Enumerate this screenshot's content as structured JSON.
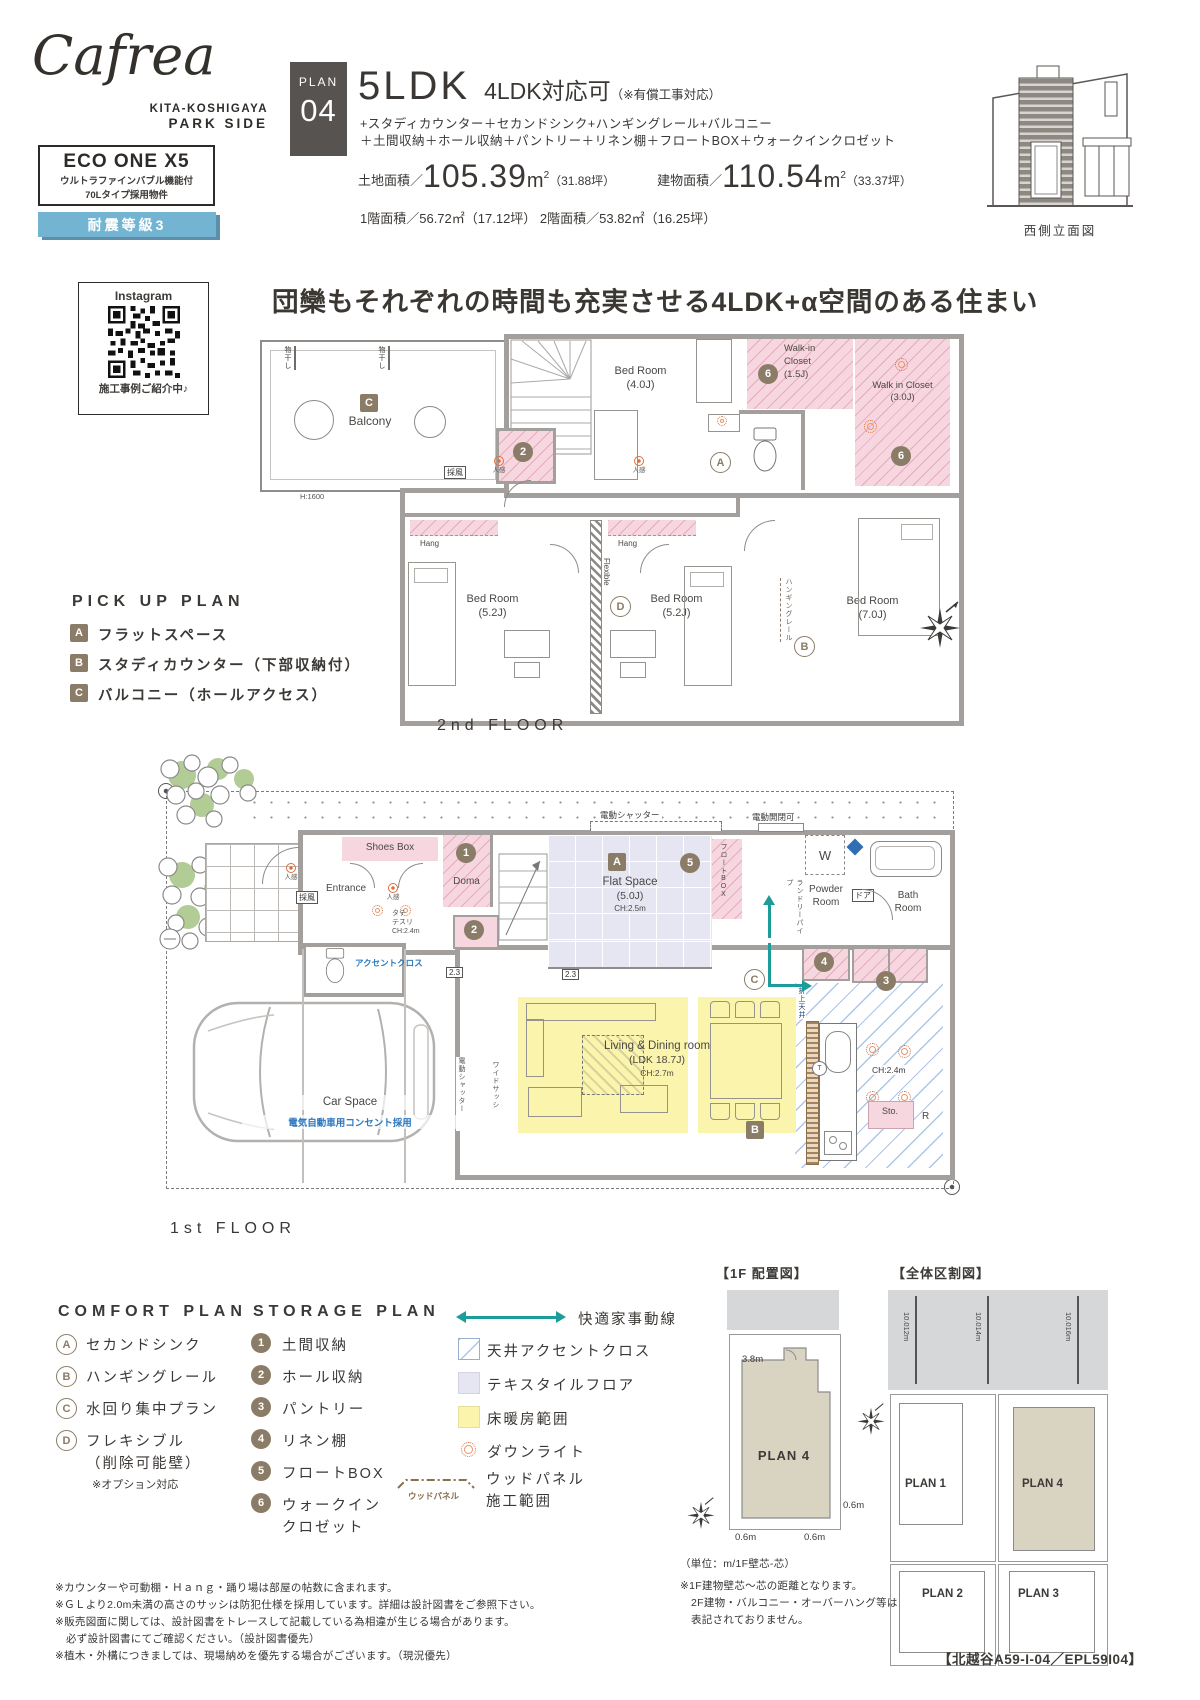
{
  "brand": {
    "logo": "Cafrea",
    "sub1": "KITA-KOSHIGAYA",
    "sub2": "PARK SIDE",
    "eco_title": "ECO ONE X5",
    "eco_line1": "ウルトラファインバブル機能付",
    "eco_line2": "70Lタイプ採用物件",
    "seismic": "耐震等級3"
  },
  "plan_header": {
    "plan_label": "PLAN",
    "plan_no": "04",
    "ldk": "5LDK",
    "convert": "4LDK対応可",
    "convert_note": "（※有償工事対応）",
    "feat1": "+スタディカウンター＋セカンドシンク+ハンギングレール+バルコニー",
    "feat2": "＋土間収納＋ホール収納＋パントリー＋リネン棚＋フロートBOX＋ウォークインクロゼット",
    "land_label": "土地面積／",
    "land_value": "105.39",
    "unit": "m",
    "sup": "2",
    "land_tsubo": "（31.88坪）",
    "bldg_label": "建物面積／",
    "bldg_value": "110.54",
    "bldg_tsubo": "（33.37坪）",
    "floor_line": "1階面積／56.72㎡（17.12坪） 2階面積／53.82㎡（16.25坪）",
    "elevation_caption": "西側立面図"
  },
  "instagram": {
    "title": "Instagram",
    "caption": "施工事例ご紹介中♪"
  },
  "headline": "団欒もそれぞれの時間も充実させる4LDK+α空間のある住まい",
  "pickup_plan": {
    "title": "PICK UP PLAN",
    "items": [
      {
        "b": "A",
        "t": "フラットスペース"
      },
      {
        "b": "B",
        "t": "スタディカウンター（下部収納付）"
      },
      {
        "b": "C",
        "t": "バルコニー（ホールアクセス）"
      }
    ]
  },
  "floor2": {
    "label": "2nd FLOOR",
    "balcony": "Balcony",
    "monohoshi": "物干し",
    "saifu": "採風",
    "h1600": "H:1600",
    "bed4": "Bed Room",
    "bed4_size": "(4.0J)",
    "ninkan": "人感",
    "wic15_l1": "Walk-in",
    "wic15_l2": "Closet",
    "wic15_size": "(1.5J)",
    "wic30": "Walk in Closet",
    "wic30_size": "(3.0J)",
    "hang": "Hang",
    "bed52": "Bed Room",
    "bed52_size": "(5.2J)",
    "flexible": "Flexible",
    "bed7": "Bed Room",
    "bed7_size": "(7.0J)",
    "hanging_rail": "ハンギングレール"
  },
  "floor1": {
    "label": "1st FLOOR",
    "shutter_top": "電動シャッター",
    "auto_open": "電動開閉可",
    "shoes": "Shoes Box",
    "doma": "Doma",
    "entrance": "Entrance",
    "saifu": "採風",
    "ninkan": "人感",
    "tate1": "タテ",
    "tate2": "テスリ",
    "tate3": "CH:2.4m",
    "flat": "Flat Space",
    "flat_size": "(5.0J)",
    "flat_ch": "CH:2.5m",
    "floatbox": "フロートBOX",
    "w": "W",
    "laundry": "ランドリーパイプ",
    "powder1": "Powder",
    "powder2": "Room",
    "door_label": "ドア",
    "bath1": "Bath",
    "bath2": "Room",
    "oriage": "折上天井",
    "ch24": "CH:2.4m",
    "sto": "Sto.",
    "r": "R",
    "ldk1": "Living & Dining room",
    "ldk2": "(LDK 18.7J)",
    "ldk3": "CH:2.7m",
    "marker23": "2.3",
    "accent_cross": "アクセントクロス",
    "car": "Car Space",
    "car_note": "電気自動車用コンセント採用",
    "shutter_side": "電動シャッター",
    "wide_sash": "ワイドサッシ",
    "t": "T"
  },
  "comfort_plan": {
    "title": "COMFORT PLAN",
    "items": [
      {
        "b": "A",
        "t": "セカンドシンク"
      },
      {
        "b": "B",
        "t": "ハンギングレール"
      },
      {
        "b": "C",
        "t": "水回り集中プラン"
      },
      {
        "b": "D",
        "t": "フレキシブル",
        "t2": "（削除可能壁）",
        "note": "※オプション対応"
      }
    ]
  },
  "storage_plan": {
    "title": "STORAGE PLAN",
    "items": [
      {
        "b": "1",
        "t": "土間収納"
      },
      {
        "b": "2",
        "t": "ホール収納"
      },
      {
        "b": "3",
        "t": "パントリー"
      },
      {
        "b": "4",
        "t": "リネン棚"
      },
      {
        "b": "5",
        "t": "フロートBOX"
      },
      {
        "b": "6",
        "t": "ウォークイン",
        "t2": "クロゼット"
      }
    ]
  },
  "legend": {
    "flow": "快適家事動線",
    "ceiling": "天井アクセントクロス",
    "textile": "テキスタイルフロア",
    "heating": "床暖房範囲",
    "downlight": "ダウンライト",
    "wood1": "ウッドパネル",
    "wood2": "施工範囲",
    "wood_tag": "ウッドパネル"
  },
  "site_1f": {
    "title": "【1F 配置図】",
    "plan": "PLAN 4",
    "dim_top": "3.8m",
    "dim_r": "0.6m",
    "dim_bl": "0.6m",
    "dim_br": "0.6m"
  },
  "site_overall": {
    "title": "【全体区割図】",
    "d1": "10.012m",
    "d2": "10.014m",
    "d3": "10.016m",
    "p1": "PLAN 1",
    "p2": "PLAN 2",
    "p3": "PLAN 3",
    "p4": "PLAN 4"
  },
  "site_notes": [
    "（単位：m/1F壁芯-芯）",
    "※1F建物壁芯～芯の距離となります。",
    "2F建物・バルコニー・オーバーハング等は",
    "表記されておりません。"
  ],
  "footer_notes": [
    "※カウンターや可動棚・Ｈａｎｇ・踊り場は部屋の帖数に含まれます。",
    "※ＧＬより2.0m未満の高さのサッシは防犯仕様を採用しています。詳細は設計図書をご参照下さい。",
    "※販売図面に関しては、設計図書をトレースして記載している為相違が生じる場合があります。",
    "必ず設計図書にてご確認ください。（設計図書優先）",
    "※植木・外構につきましては、現場納めを優先する場合がございます。（現況優先）"
  ],
  "doc_code": "【北越谷A59-I-04／EPL59I04】"
}
